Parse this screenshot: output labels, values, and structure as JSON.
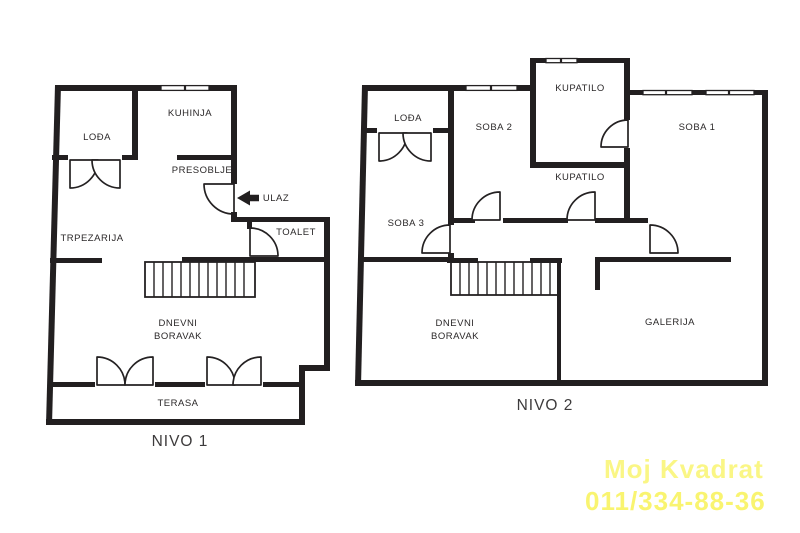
{
  "floorplan": {
    "level1": {
      "title": "NIVO 1",
      "rooms": {
        "lodja": "LOĐA",
        "kuhinja": "KUHINJA",
        "presoblje": "PRESOBLJE",
        "ulaz": "ULAZ",
        "trpezarija": "TRPEZARIJA",
        "toalet": "TOALET",
        "dnevni_line1": "DNEVNI",
        "dnevni_line2": "BORAVAK",
        "terasa": "TERASA"
      }
    },
    "level2": {
      "title": "NIVO 2",
      "rooms": {
        "lodja": "LOĐA",
        "soba2": "SOBA 2",
        "kupatilo_top": "KUPATILO",
        "kupatilo_mid": "KUPATILO",
        "soba1": "SOBA 1",
        "soba3": "SOBA 3",
        "dnevni_line1": "DNEVNI",
        "dnevni_line2": "BORAVAK",
        "galerija": "GALERIJA"
      }
    },
    "watermark": {
      "line1": "Moj Kvadrat",
      "line2": "011/334-88-36"
    },
    "colors": {
      "wall": "#221f20",
      "label": "#2b2829",
      "background": "#ffffff",
      "watermark": "#f9f464"
    }
  }
}
